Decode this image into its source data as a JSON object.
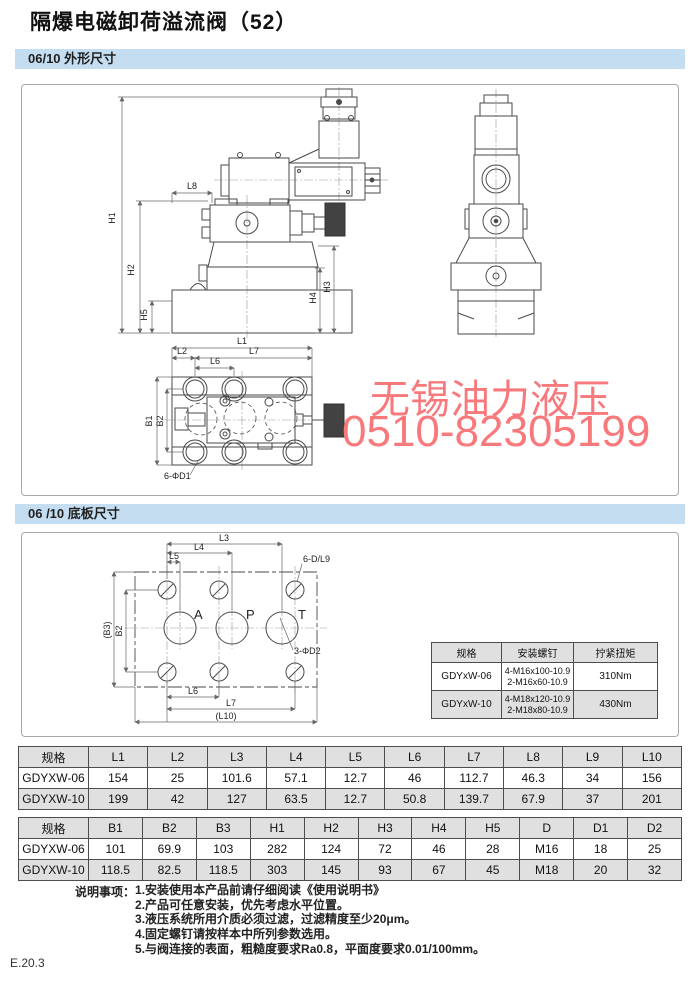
{
  "page": {
    "title": "隔爆电磁卸荷溢流阀（52）",
    "footer": "E.20.3"
  },
  "colors": {
    "section_bar": "#c4ddf1",
    "watermark_red": "#f8797c",
    "table_shade": "#e0e0e0"
  },
  "sections": {
    "outline_header": "06/10 外形尺寸",
    "baseplate_header": "06 /10 底板尺寸"
  },
  "watermark": {
    "line1": "无锡油力液压",
    "line2": "0510-82305199"
  },
  "outline_drawing": {
    "labels": {
      "h1": "H1",
      "h2": "H2",
      "h3": "H3",
      "h4": "H4",
      "h5": "H5",
      "l8": "L8"
    }
  },
  "topview_drawing": {
    "labels": {
      "l1": "L1",
      "l2": "L2",
      "l6": "L6",
      "l7": "L7",
      "b1": "B1",
      "b2": "B2",
      "d1": "6-ΦD1"
    }
  },
  "baseplate_drawing": {
    "labels": {
      "l3": "L3",
      "l4": "L4",
      "l5": "L5",
      "l6": "L6",
      "l7": "L7",
      "l10": "(L10)",
      "b2": "B2",
      "b3": "(B3)",
      "dl9": "6-D/L9",
      "d2": "3-ΦD2",
      "port_a": "A",
      "port_p": "P",
      "port_t": "T"
    }
  },
  "screw_table": {
    "headers": [
      "规格",
      "安装螺钉",
      "拧紧扭矩"
    ],
    "rows": [
      {
        "spec": "GDYxW-06",
        "screw1": "4-M16x100-10.9",
        "screw2": "2-M16x60-10.9",
        "torque": "310Nm"
      },
      {
        "spec": "GDYxW-10",
        "screw1": "4-M18x120-10.9",
        "screw2": "2-M18x80-10.9",
        "torque": "430Nm"
      }
    ]
  },
  "dim_table_l": {
    "headers": [
      "规格",
      "L1",
      "L2",
      "L3",
      "L4",
      "L5",
      "L6",
      "L7",
      "L8",
      "L9",
      "L10"
    ],
    "rows": [
      [
        "GDYXW-06",
        "154",
        "25",
        "101.6",
        "57.1",
        "12.7",
        "46",
        "112.7",
        "46.3",
        "34",
        "156"
      ],
      [
        "GDYXW-10",
        "199",
        "42",
        "127",
        "63.5",
        "12.7",
        "50.8",
        "139.7",
        "67.9",
        "37",
        "201"
      ]
    ]
  },
  "dim_table_b": {
    "headers": [
      "规格",
      "B1",
      "B2",
      "B3",
      "H1",
      "H2",
      "H3",
      "H4",
      "H5",
      "D",
      "D1",
      "D2"
    ],
    "rows": [
      [
        "GDYXW-06",
        "101",
        "69.9",
        "103",
        "282",
        "124",
        "72",
        "46",
        "28",
        "M16",
        "18",
        "25"
      ],
      [
        "GDYXW-10",
        "118.5",
        "82.5",
        "118.5",
        "303",
        "145",
        "93",
        "67",
        "45",
        "M18",
        "20",
        "32"
      ]
    ]
  },
  "notes": {
    "label": "说明事项：",
    "items": [
      "1.安装使用本产品前请仔细阅读《使用说明书》",
      "2.产品可任意安装，优先考虑水平位置。",
      "3.液压系统所用介质必须过滤，过滤精度至少20μm。",
      "4.固定螺钉请按样本中所列参数选用。",
      "5.与阀连接的表面，粗糙度要求Ra0.8，平面度要求0.01/100mm。"
    ]
  }
}
